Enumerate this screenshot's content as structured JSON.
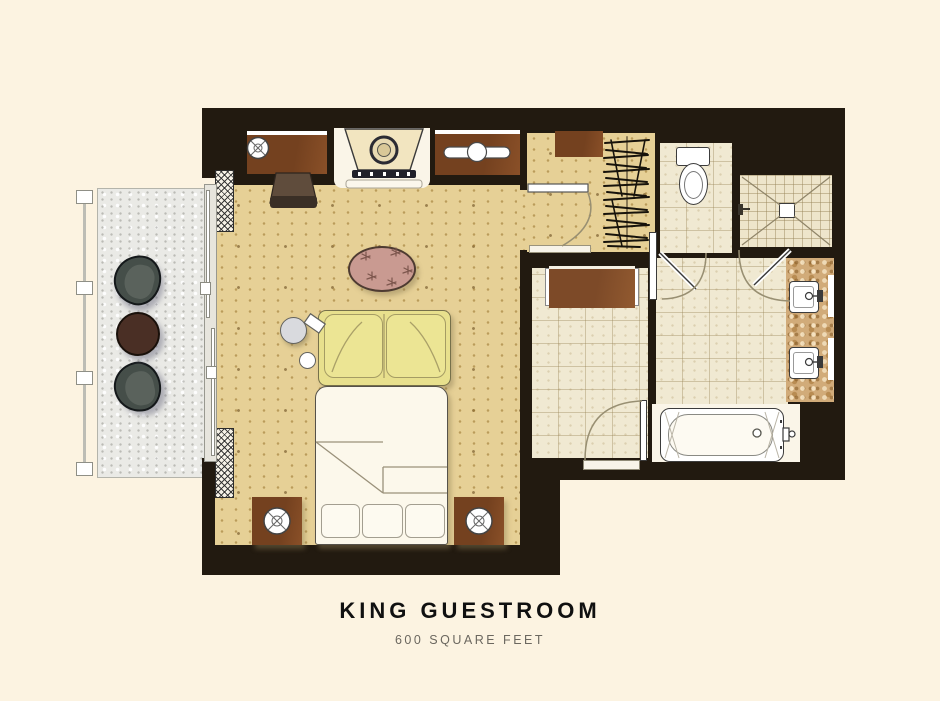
{
  "caption": {
    "title": "KING GUESTROOM",
    "subtitle": "600 SQUARE FEET"
  },
  "palette": {
    "bg": "#fcf3e1",
    "wall": "#221a10",
    "sand": "#e6d096",
    "balcony": "#eaeae6",
    "tile": "#f0e9d2",
    "shower": "#eee5cb",
    "marble": "#d1ab79",
    "wood": "#74411f",
    "wood2": "#7d4a28",
    "sofa": "#e8e08d",
    "linen": "#fcf8eb",
    "rug": "#c99a91",
    "chairDark": "#454e49",
    "tableDark": "#4a2f25",
    "arc": "#988f72",
    "ink": "#101010",
    "sub": "#6b675f"
  },
  "fixtures": {
    "balcony": [
      "railing",
      "lounge-chair",
      "lounge-chair",
      "round-table",
      "sliding-glass-door"
    ],
    "bedroom": [
      "desk",
      "desk-lamp",
      "desk-chair",
      "tv-console",
      "dresser",
      "area-rug",
      "sofa",
      "side-table",
      "stool",
      "king-bed",
      "pillows",
      "nightstand",
      "nightstand-lamp",
      "curtains"
    ],
    "vestibule": [
      "closet-hangers",
      "luggage-rack",
      "door"
    ],
    "corridor": [
      "console-table",
      "entry-door"
    ],
    "bathroom": [
      "toilet",
      "shower",
      "shower-head",
      "vanity-sink",
      "vanity-sink",
      "bathtub",
      "tub-faucet",
      "bathroom-door"
    ]
  }
}
